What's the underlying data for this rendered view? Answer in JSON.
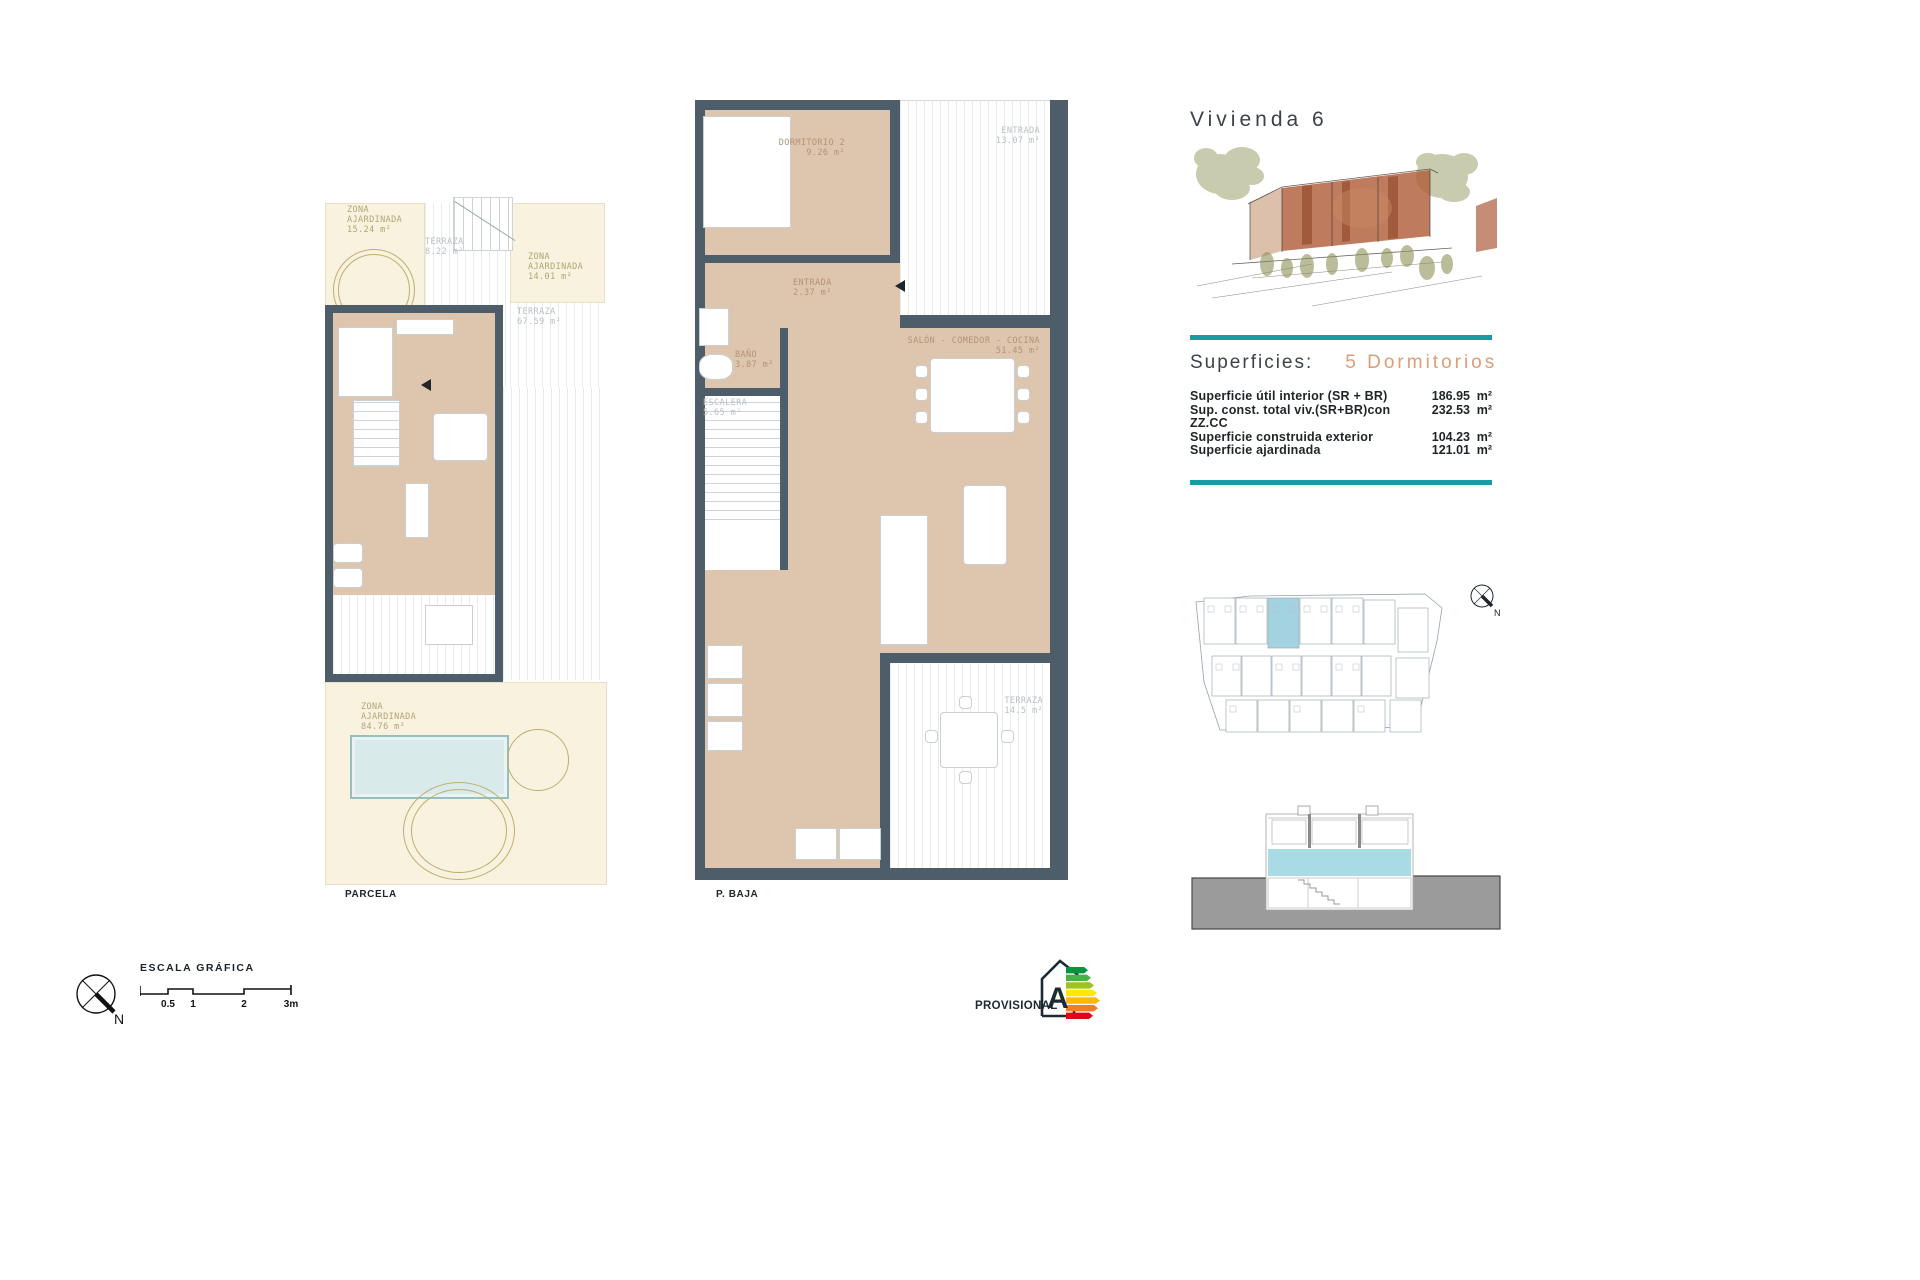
{
  "header": {
    "title": "Vivienda 6"
  },
  "superficies": {
    "label": "Superficies:",
    "bedrooms": "5 Dormitorios",
    "rows": [
      {
        "label": "Superficie útil interior (SR + BR)",
        "value": "186.95",
        "unit": "m²"
      },
      {
        "label": "Sup. const. total viv.(SR+BR)con ZZ.CC",
        "value": "232.53",
        "unit": "m²"
      },
      {
        "label": "Superficie construida exterior",
        "value": "104.23",
        "unit": "m²"
      },
      {
        "label": "Superficie ajardinada",
        "value": "121.01",
        "unit": "m²"
      }
    ]
  },
  "parcela": {
    "caption": "PARCELA",
    "labels": {
      "garden_top": "ZONA\nAJARDINADA\n15.24 m²",
      "terraza_small": "TERRAZA\n8.22 m²",
      "garden_right": "ZONA\nAJARDINADA\n14.01 m²",
      "terraza_large": "TERRAZA\n67.59 m²",
      "garden_bottom": "ZONA\nAJARDINADA\n84.76 m²"
    }
  },
  "pbaja": {
    "caption": "P. BAJA",
    "labels": {
      "dormitorio2": "DORMITORIO 2\n9.26 m²",
      "entrada_terraza": "ENTRADA\n13.07 m²",
      "entrada": "ENTRADA\n2.37 m²",
      "bano": "BAÑO\n3.87 m²",
      "escalera": "ESCALERA\n5.65 m²",
      "salon": "SALÓN - COMEDOR - COCINA\n51.45 m²",
      "terraza": "TERRAZA\n14.5 m²"
    }
  },
  "scalebar": {
    "title": "ESCALA GRÁFICA",
    "ticks": [
      "0.5",
      "1",
      "2",
      "3m"
    ]
  },
  "footer": {
    "provisional": "PROVISIONAL",
    "energy_letter": "A"
  },
  "compass": {
    "north": "N"
  },
  "colors": {
    "wall": "#4e5d6a",
    "floor": "#dec5ad",
    "garden": "#f8f2df",
    "pool": "#d9eaea",
    "teal_rule": "#1a9aa4",
    "accent_text": "#db9e79",
    "unit_highlight": "#a3d3e0",
    "section_ground": "#9b9b9b",
    "section_band": "#a9dbe4",
    "energy_bars": [
      "#009640",
      "#4faf47",
      "#9fc21c",
      "#ffe800",
      "#fbb900",
      "#f07e26",
      "#e30613"
    ]
  }
}
